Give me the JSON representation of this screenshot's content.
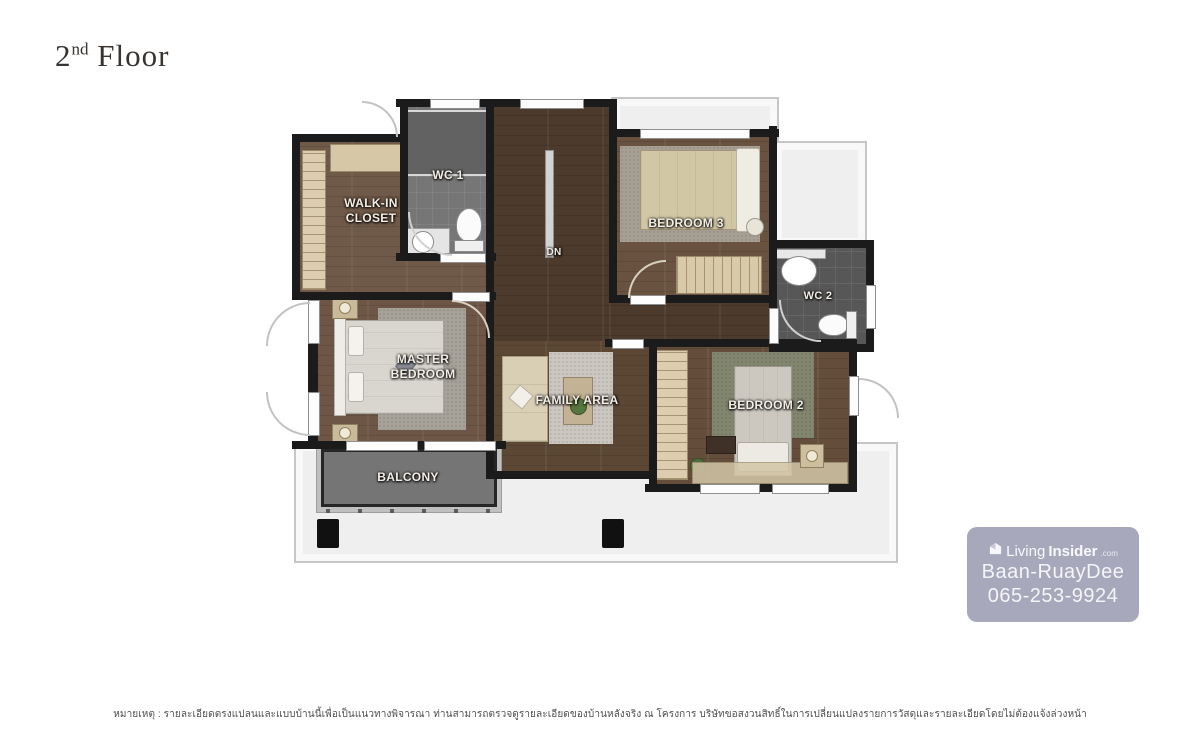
{
  "page_title": {
    "number": "2",
    "ordinal": "nd",
    "text": "Floor"
  },
  "plan": {
    "labels": {
      "walk_in_line1": "WALK-IN",
      "walk_in_line2": "CLOSET",
      "wc1": "WC 1",
      "stairs_dn": "DN",
      "bedroom3": "BEDROOM 3",
      "wc2": "WC 2",
      "master_line1": "MASTER",
      "master_line2": "BEDROOM",
      "family_area": "FAMILY AREA",
      "bedroom2": "BEDROOM 2",
      "balcony": "BALCONY"
    },
    "colors": {
      "wall": "#1b1b1b",
      "wood_dark": "#4c3a2d",
      "wood_medium": "#69523f",
      "tile_gray": "#6f6f6f",
      "balcony_gray": "#757575",
      "roof_light": "#efefef",
      "closet_beige": "#dbcdad"
    }
  },
  "watermark": {
    "brand_living": "Living",
    "brand_insider": "Insider",
    "brand_tld": ".com",
    "agent_name": "Baan-RuayDee",
    "phone": "065-253-9924",
    "background": "#9f9fb5"
  },
  "footnote": "หมายเหตุ : รายละเอียดตรงแปลนและแบบบ้านนี้เพื่อเป็นแนวทางพิจารณา ท่านสามารถตรวจดูรายละเอียดของบ้านหลังจริง ณ โครงการ บริษัทขอสงวนสิทธิ์ในการเปลี่ยนแปลงรายการวัสดุและรายละเอียดโดยไม่ต้องแจ้งล่วงหน้า"
}
